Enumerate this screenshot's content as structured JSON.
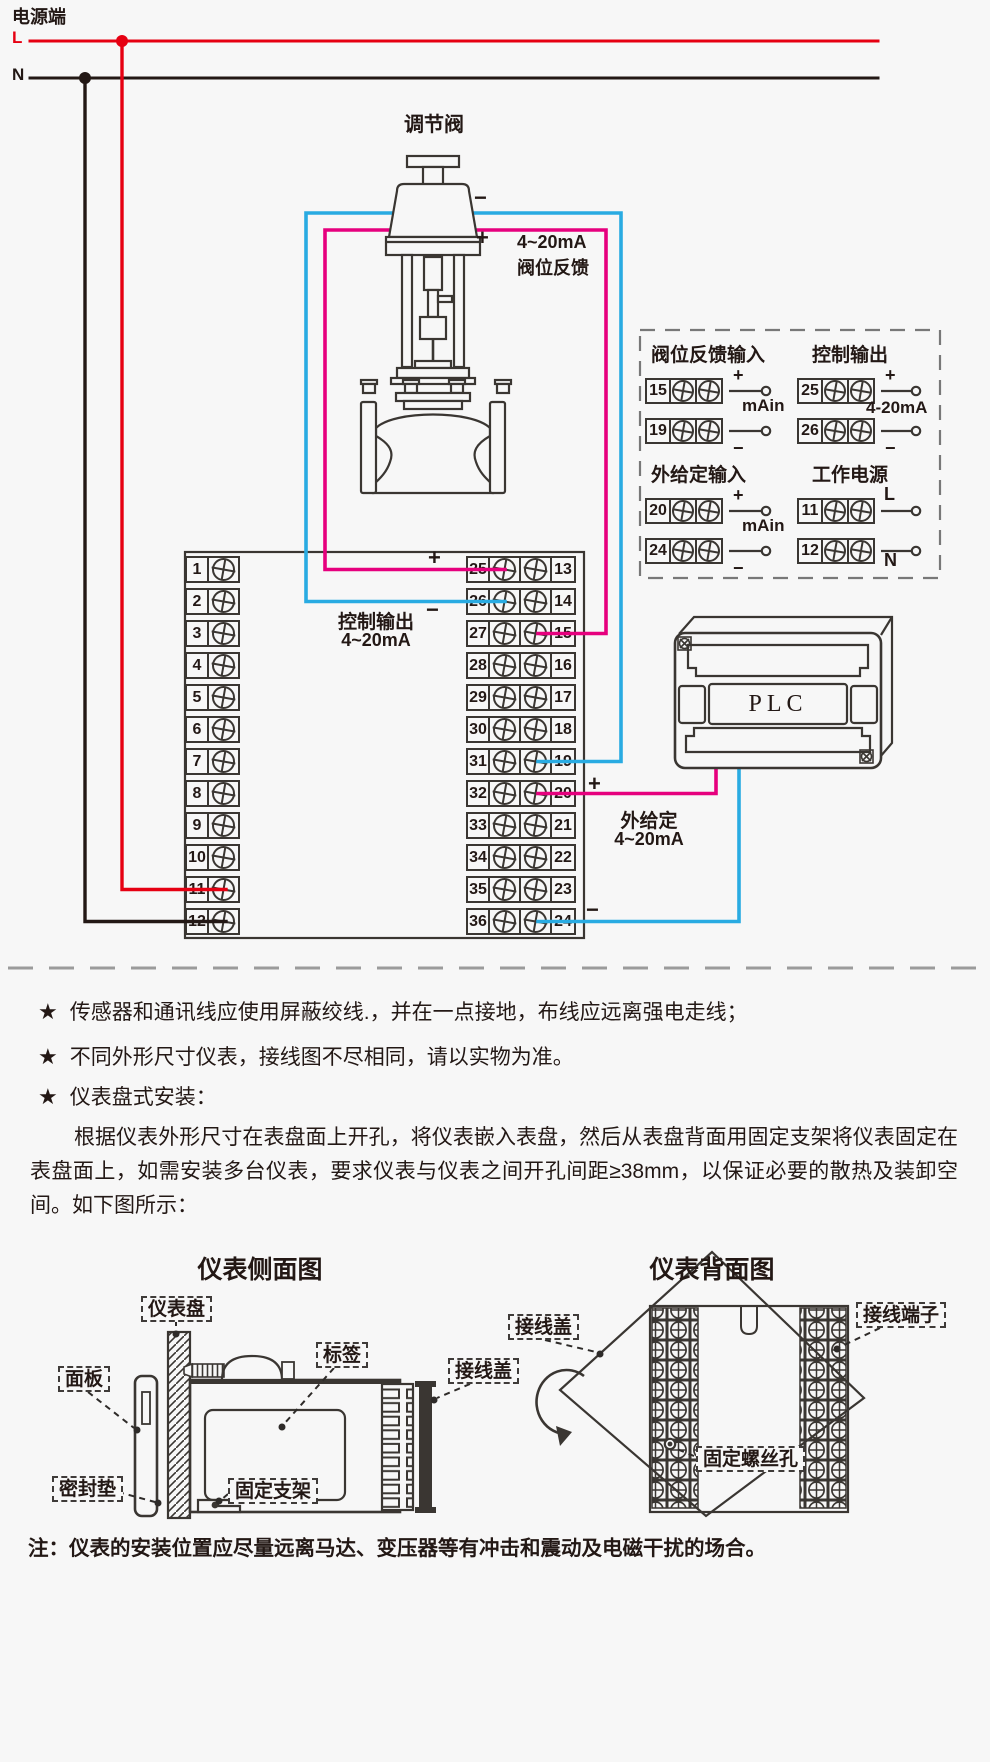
{
  "power": {
    "title": "电源端",
    "live": "L",
    "neutral": "N"
  },
  "valve": {
    "title": "调节阀",
    "minus": "−",
    "plus": "+",
    "feedback_range": "4~20mA",
    "feedback_name": "阀位反馈"
  },
  "terminal_block": {
    "left": [
      "1",
      "2",
      "3",
      "4",
      "5",
      "6",
      "7",
      "8",
      "9",
      "10",
      "11",
      "12"
    ],
    "middle_left": [
      "25",
      "26",
      "27",
      "28",
      "29",
      "30",
      "31",
      "32",
      "33",
      "34",
      "35",
      "36"
    ],
    "middle_right": [
      "13",
      "14",
      "15",
      "16",
      "17",
      "18",
      "19",
      "20",
      "21",
      "22",
      "23",
      "24"
    ],
    "control_output_title": "控制输出",
    "control_output_range": "4~20mA",
    "plus": "+",
    "minus": "−",
    "setpoint_title": "外给定",
    "setpoint_range": "4~20mA"
  },
  "plc": {
    "label": "PLC"
  },
  "info_box": {
    "groups": [
      {
        "title": "阀位反馈输入",
        "range_label": "mAin",
        "terminals": [
          {
            "no": "15",
            "sign": "+"
          },
          {
            "no": "19",
            "sign": "−"
          }
        ]
      },
      {
        "title": "控制输出",
        "range_label": "4-20mA",
        "terminals": [
          {
            "no": "25",
            "sign": "+"
          },
          {
            "no": "26",
            "sign": "−"
          }
        ]
      },
      {
        "title": "外给定输入",
        "range_label": "mAin",
        "terminals": [
          {
            "no": "20",
            "sign": "+"
          },
          {
            "no": "24",
            "sign": "−"
          }
        ]
      },
      {
        "title": "工作电源",
        "range_label": "",
        "terminals": [
          {
            "no": "11",
            "sign": "L"
          },
          {
            "no": "12",
            "sign": "N"
          }
        ]
      }
    ]
  },
  "notes": {
    "star": "★",
    "bullets": [
      "传感器和通讯线应使用屏蔽绞线.，并在一点接地，布线应远离强电走线；",
      "不同外形尺寸仪表，接线图不尽相同，请以实物为准。",
      "仪表盘式安装："
    ],
    "paragraph": "根据仪表外形尺寸在表盘面上开孔，将仪表嵌入表盘，然后从表盘背面用固定支架将仪表固定在表盘面上，如需安装多台仪表，要求仪表与仪表之间开孔间距≥38mm，以保证必要的散热及装卸空间。如下图所示："
  },
  "diagrams": {
    "side": {
      "title": "仪表侧面图",
      "labels": {
        "panel_board": "仪表盘",
        "label_tag": "标签",
        "wiring_cover": "接线盖",
        "front_panel": "面板",
        "seal_gasket": "密封垫",
        "fixing_bracket": "固定支架"
      }
    },
    "back": {
      "title": "仪表背面图",
      "labels": {
        "wiring_cover": "接线盖",
        "terminals": "接线端子",
        "screw_hole": "固定螺丝孔"
      }
    }
  },
  "footer_note": "注：仪表的安装位置应尽量远离马达、变压器等有冲击和震动及电磁干扰的场合。",
  "colors": {
    "background": "#f7f7f7",
    "line_art": "#3a3632",
    "live_wire": "#e60012",
    "neutral_wire": "#231815",
    "signal_blue": "#29abe2",
    "signal_magenta": "#e6007e"
  }
}
